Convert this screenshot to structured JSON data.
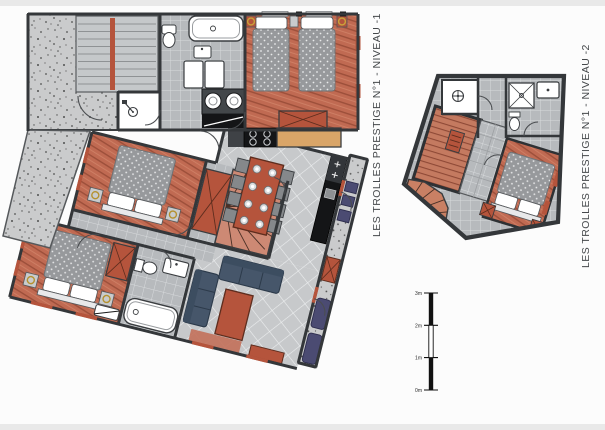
{
  "sheet": {
    "background": "#fcfcfc",
    "frame_strip_color": "#e9e9e9"
  },
  "plan_left": {
    "title": "LES TROLLES PRESTIGE N°1 - NIVEAU -1"
  },
  "plan_right": {
    "title": "LES TROLLES PRESTIGE N°1 - NIVEAU -2"
  },
  "scale_bar": {
    "labels": [
      "3m",
      "2m",
      "1m",
      "0m"
    ]
  },
  "colors": {
    "wall": "#34373a",
    "accent": "#b5543c",
    "counter": "#d9a568",
    "sofa": "#46566a",
    "balcony": "#4b4b72",
    "appliance": "#141517",
    "wood_floor": "#c06a52",
    "tile_floor": "#c0c3c5",
    "concrete": "#cacbcc"
  }
}
